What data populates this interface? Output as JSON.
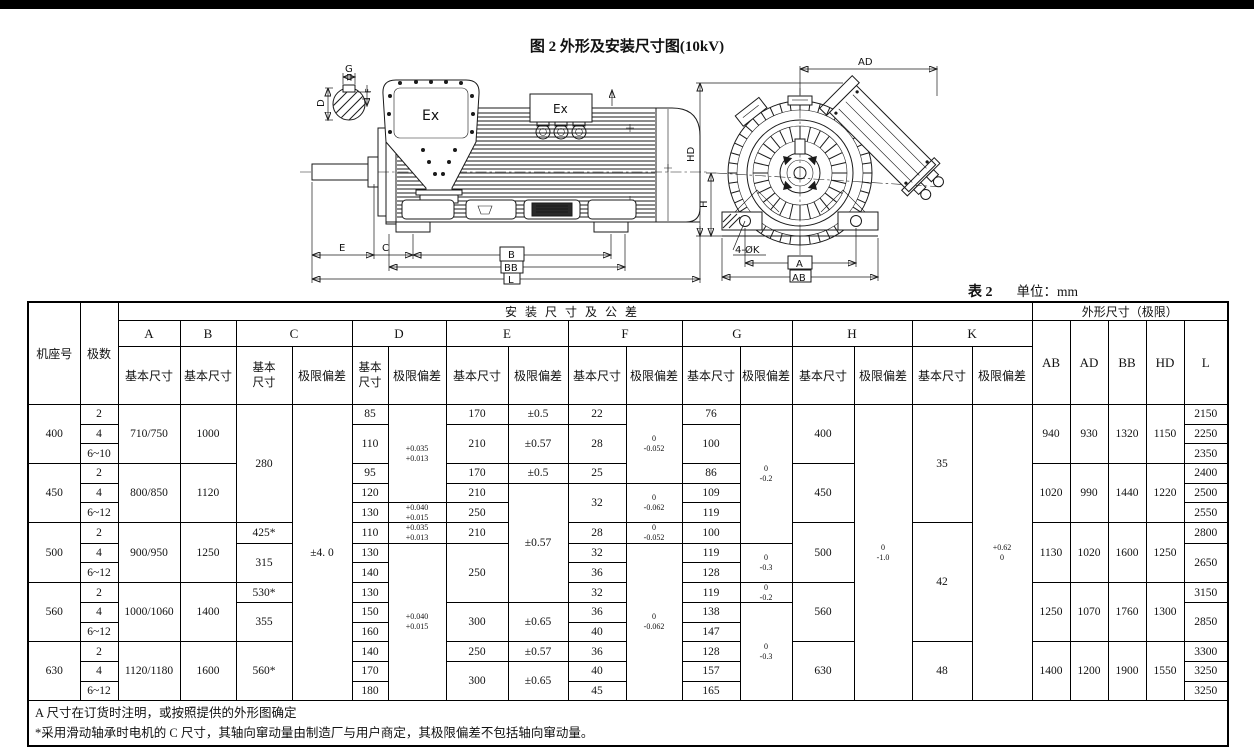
{
  "page": {
    "title": "图 2 外形及安装尺寸图(10kV)",
    "table_no": "表 2",
    "unit": "单位：mm"
  },
  "diagram": {
    "labels": {
      "ex_main": "Ex",
      "ex_aux": "Ex",
      "g": "G",
      "d": "D",
      "f": "F",
      "e": "E",
      "c": "C",
      "b": "B",
      "bb": "BB",
      "l": "L",
      "ad": "AD",
      "hd": "HD",
      "h": "H",
      "k_holes": "4-ØK",
      "a": "A",
      "ab": "AB"
    }
  },
  "table": {
    "col_widths": [
      52,
      38,
      62,
      56,
      56,
      60,
      36,
      58,
      62,
      60,
      58,
      56,
      58,
      52,
      62,
      58,
      60,
      60,
      38,
      38,
      38,
      38,
      44
    ],
    "header_rows": [
      [
        {
          "t": "机座号",
          "rs": 3,
          "n": "header-frame"
        },
        {
          "t": "极数",
          "rs": 3,
          "n": "header-poles"
        },
        {
          "t": "安装尺寸及公差",
          "cs": 16,
          "cls": "grp",
          "n": "header-install-group"
        },
        {
          "t": "外形尺寸（极限）",
          "cs": 5,
          "n": "header-outline-group"
        }
      ],
      [
        {
          "t": "A",
          "cls": "ltr"
        },
        {
          "t": "B",
          "cls": "ltr"
        },
        {
          "t": "C",
          "cs": 2,
          "cls": "ltr"
        },
        {
          "t": "D",
          "cs": 2,
          "cls": "ltr"
        },
        {
          "t": "E",
          "cs": 2,
          "cls": "ltr"
        },
        {
          "t": "F",
          "cs": 2,
          "cls": "ltr"
        },
        {
          "t": "G",
          "cs": 2,
          "cls": "ltr"
        },
        {
          "t": "H",
          "cs": 2,
          "cls": "ltr"
        },
        {
          "t": "K",
          "cs": 2,
          "cls": "ltr"
        },
        {
          "t": "AB",
          "rs": 2,
          "cls": "ltr"
        },
        {
          "t": "AD",
          "rs": 2,
          "cls": "ltr"
        },
        {
          "t": "BB",
          "rs": 2,
          "cls": "ltr"
        },
        {
          "t": "HD",
          "rs": 2,
          "cls": "ltr"
        },
        {
          "t": "L",
          "rs": 2,
          "cls": "ltr"
        }
      ],
      [
        {
          "t": "基本尺寸"
        },
        {
          "t": "基本尺寸"
        },
        {
          "t": "基本\n尺寸",
          "cls": "two"
        },
        {
          "t": "极限偏差"
        },
        {
          "t": "基本\n尺寸",
          "cls": "two"
        },
        {
          "t": "极限偏差"
        },
        {
          "t": "基本尺寸"
        },
        {
          "t": "极限偏差"
        },
        {
          "t": "基本尺寸"
        },
        {
          "t": "极限偏差"
        },
        {
          "t": "基本尺寸"
        },
        {
          "t": "极限偏差"
        },
        {
          "t": "基本尺寸"
        },
        {
          "t": "极限偏差"
        },
        {
          "t": "基本尺寸"
        },
        {
          "t": "极限偏差"
        }
      ]
    ],
    "body": [
      [
        {
          "t": "400",
          "rs": 3
        },
        {
          "t": "2"
        },
        {
          "t": "710/750",
          "rs": 3
        },
        {
          "t": "1000",
          "rs": 3
        },
        {
          "t": "280",
          "rs": 6
        },
        {
          "t": "±4. 0",
          "rs": 15
        },
        {
          "t": "85"
        },
        {
          "t": "+0.035\n+0.013",
          "rs": 5,
          "cls": "dev"
        },
        {
          "t": "170"
        },
        {
          "t": "±0.5"
        },
        {
          "t": "22"
        },
        {
          "t": "0\n-0.052",
          "rs": 4,
          "cls": "dev"
        },
        {
          "t": "76"
        },
        {
          "t": "0\n-0.2",
          "rs": 7,
          "cls": "dev"
        },
        {
          "t": "400",
          "rs": 3
        },
        {
          "t": "0\n-1.0",
          "rs": 15,
          "cls": "dev"
        },
        {
          "t": "35",
          "rs": 6
        },
        {
          "t": "+0.62\n0",
          "rs": 15,
          "cls": "dev"
        },
        {
          "t": "940",
          "rs": 3
        },
        {
          "t": "930",
          "rs": 3
        },
        {
          "t": "1320",
          "rs": 3
        },
        {
          "t": "1150",
          "rs": 3
        },
        {
          "t": "2150"
        }
      ],
      [
        {
          "t": "4"
        },
        {
          "t": "110",
          "rs": 2
        },
        {
          "t": "210",
          "rs": 2
        },
        {
          "t": "±0.57",
          "rs": 2
        },
        {
          "t": "28",
          "rs": 2
        },
        {
          "t": "100",
          "rs": 2
        },
        {
          "t": "2250"
        }
      ],
      [
        {
          "t": "6~10"
        },
        {
          "t": "2350"
        }
      ],
      [
        {
          "t": "450",
          "rs": 3
        },
        {
          "t": "2"
        },
        {
          "t": "800/850",
          "rs": 3
        },
        {
          "t": "1120",
          "rs": 3
        },
        {
          "t": "95"
        },
        {
          "t": "170"
        },
        {
          "t": "±0.5"
        },
        {
          "t": "25"
        },
        {
          "t": "86"
        },
        {
          "t": "450",
          "rs": 3
        },
        {
          "t": "1020",
          "rs": 3
        },
        {
          "t": "990",
          "rs": 3
        },
        {
          "t": "1440",
          "rs": 3
        },
        {
          "t": "1220",
          "rs": 3
        },
        {
          "t": "2400"
        }
      ],
      [
        {
          "t": "4"
        },
        {
          "t": "120"
        },
        {
          "t": "210"
        },
        {
          "t": "±0.57",
          "rs": 6
        },
        {
          "t": "32",
          "rs": 2
        },
        {
          "t": "0\n-0.062",
          "rs": 2,
          "cls": "dev"
        },
        {
          "t": "109"
        },
        {
          "t": "2500"
        }
      ],
      [
        {
          "t": "6~12"
        },
        {
          "t": "130"
        },
        {
          "t": "+0.040\n+0.015",
          "cls": "dev"
        },
        {
          "t": "250"
        },
        {
          "t": "119"
        },
        {
          "t": "2550"
        }
      ],
      [
        {
          "t": "500",
          "rs": 3
        },
        {
          "t": "2"
        },
        {
          "t": "900/950",
          "rs": 3
        },
        {
          "t": "1250",
          "rs": 3
        },
        {
          "t": "425*"
        },
        {
          "t": "110"
        },
        {
          "t": "+0.035\n+0.013",
          "cls": "dev"
        },
        {
          "t": "210"
        },
        {
          "t": "28"
        },
        {
          "t": "0\n-0.052",
          "cls": "dev"
        },
        {
          "t": "100"
        },
        {
          "t": "500",
          "rs": 3
        },
        {
          "t": "42",
          "rs": 6
        },
        {
          "t": "1130",
          "rs": 3
        },
        {
          "t": "1020",
          "rs": 3
        },
        {
          "t": "1600",
          "rs": 3
        },
        {
          "t": "1250",
          "rs": 3
        },
        {
          "t": "2800"
        }
      ],
      [
        {
          "t": "4"
        },
        {
          "t": "315",
          "rs": 2
        },
        {
          "t": "130"
        },
        {
          "t": "+0.040\n+0.015",
          "rs": 8,
          "cls": "dev"
        },
        {
          "t": "250",
          "rs": 3
        },
        {
          "t": "32"
        },
        {
          "t": "0\n-0.062",
          "rs": 8,
          "cls": "dev"
        },
        {
          "t": "119"
        },
        {
          "t": "0\n-0.3",
          "rs": 2,
          "cls": "dev"
        },
        {
          "t": "2650",
          "rs": 2
        }
      ],
      [
        {
          "t": "6~12"
        },
        {
          "t": "140"
        },
        {
          "t": "36"
        },
        {
          "t": "128"
        }
      ],
      [
        {
          "t": "560",
          "rs": 3
        },
        {
          "t": "2"
        },
        {
          "t": "1000/1060",
          "rs": 3
        },
        {
          "t": "1400",
          "rs": 3
        },
        {
          "t": "530*"
        },
        {
          "t": "130"
        },
        {
          "t": "32"
        },
        {
          "t": "119"
        },
        {
          "t": "0\n-0.2",
          "cls": "dev"
        },
        {
          "t": "560",
          "rs": 3
        },
        {
          "t": "1250",
          "rs": 3
        },
        {
          "t": "1070",
          "rs": 3
        },
        {
          "t": "1760",
          "rs": 3
        },
        {
          "t": "1300",
          "rs": 3
        },
        {
          "t": "3150"
        }
      ],
      [
        {
          "t": "4"
        },
        {
          "t": "355",
          "rs": 2
        },
        {
          "t": "150"
        },
        {
          "t": "300",
          "rs": 2
        },
        {
          "t": "±0.65",
          "rs": 2
        },
        {
          "t": "36"
        },
        {
          "t": "138"
        },
        {
          "t": "0\n-0.3",
          "rs": 5,
          "cls": "dev"
        },
        {
          "t": "2850",
          "rs": 2
        }
      ],
      [
        {
          "t": "6~12"
        },
        {
          "t": "160"
        },
        {
          "t": "40"
        },
        {
          "t": "147"
        }
      ],
      [
        {
          "t": "630",
          "rs": 3
        },
        {
          "t": "2"
        },
        {
          "t": "1120/1180",
          "rs": 3
        },
        {
          "t": "1600",
          "rs": 3
        },
        {
          "t": "560*",
          "rs": 3
        },
        {
          "t": "140"
        },
        {
          "t": "250"
        },
        {
          "t": "±0.57"
        },
        {
          "t": "36"
        },
        {
          "t": "128"
        },
        {
          "t": "630",
          "rs": 3
        },
        {
          "t": "48",
          "rs": 3
        },
        {
          "t": "1400",
          "rs": 3
        },
        {
          "t": "1200",
          "rs": 3
        },
        {
          "t": "1900",
          "rs": 3
        },
        {
          "t": "1550",
          "rs": 3
        },
        {
          "t": "3300"
        }
      ],
      [
        {
          "t": "4"
        },
        {
          "t": "170"
        },
        {
          "t": "300",
          "rs": 2
        },
        {
          "t": "±0.65",
          "rs": 2
        },
        {
          "t": "40"
        },
        {
          "t": "157"
        },
        {
          "t": "3250"
        }
      ],
      [
        {
          "t": "6~12"
        },
        {
          "t": "180"
        },
        {
          "t": "45"
        },
        {
          "t": "165"
        },
        {
          "t": "3250"
        }
      ]
    ],
    "notes": [
      "A 尺寸在订货时注明，或按照提供的外形图确定",
      "*采用滑动轴承时电机的 C 尺寸，其轴向窜动量由制造厂与用户商定，其极限偏差不包括轴向窜动量。"
    ]
  }
}
